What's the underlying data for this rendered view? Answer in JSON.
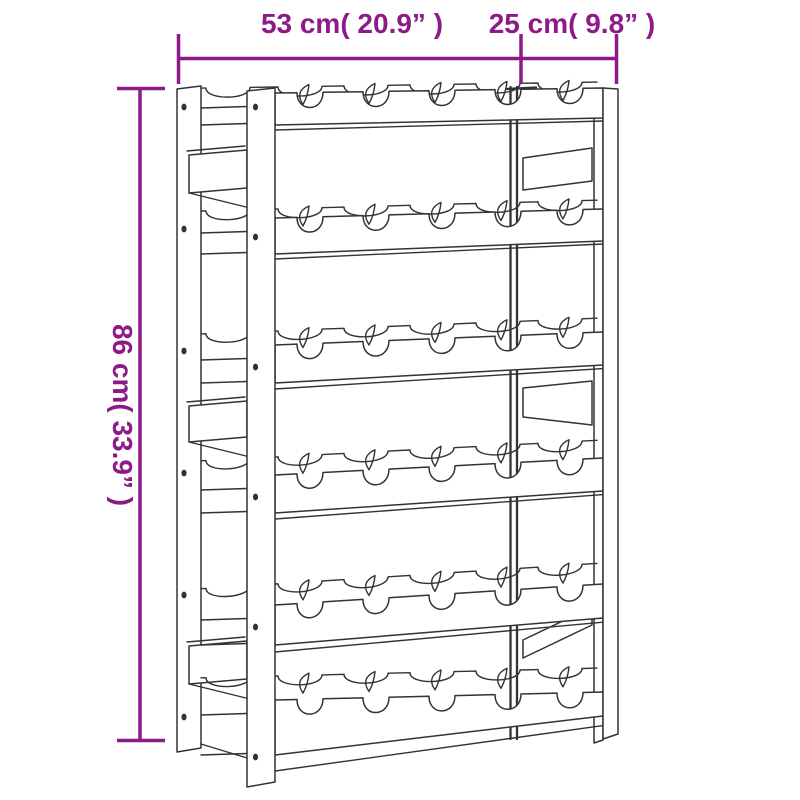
{
  "illustration": {
    "subject": "wooden wine rack line drawing",
    "shelf_rows": 6,
    "bottle_slots_per_row": 5
  },
  "dimensions": {
    "width": {
      "label": "53 cm( 20.9” )"
    },
    "depth": {
      "label": "25 cm( 9.8” )"
    },
    "height": {
      "label": "86 cm( 33.9” )"
    }
  },
  "colors": {
    "dimension_accent": "#8d1a88",
    "line_art": "#333333",
    "background": "#ffffff"
  },
  "drawing": {
    "rail_x": [
      275,
      603
    ],
    "back_x": [
      201,
      597
    ],
    "notch_centers": [
      310,
      376,
      442,
      508,
      570
    ],
    "back_notch_centers": [
      228,
      300,
      366,
      432,
      498,
      560
    ],
    "rows": [
      {
        "y": 93,
        "slope": -5,
        "back_offset": -6,
        "h_left": 32,
        "h_right": 30,
        "sub": 5
      },
      {
        "y": 218,
        "slope": -9,
        "back_offset": -9,
        "h_left": 36,
        "h_right": 32,
        "sub": 5
      },
      {
        "y": 345,
        "slope": -13,
        "back_offset": -14,
        "h_left": 38,
        "h_right": 33,
        "sub": 6
      },
      {
        "y": 475,
        "slope": -17,
        "back_offset": -18,
        "h_left": 38,
        "h_right": 33,
        "sub": 6
      },
      {
        "y": 605,
        "slope": -21,
        "back_offset": -21,
        "h_left": 40,
        "h_right": 34,
        "sub": 7
      },
      {
        "y": 700,
        "slope": -8,
        "back_offset": -24,
        "h_left": 55,
        "h_right": 24,
        "sub": 16
      }
    ],
    "gap_line_x": [
      201,
      247
    ],
    "screw_dots": {
      "back_post_x": 184,
      "back_post_ys": [
        107,
        229,
        351,
        473,
        595,
        717
      ],
      "front_post_x": 255.5,
      "front_post_ys": [
        107,
        237,
        367,
        497,
        627,
        757
      ]
    },
    "back_right_strip": {
      "x1": 510.5,
      "x2": 517,
      "y_top": 87,
      "y_bottom": 739
    }
  }
}
